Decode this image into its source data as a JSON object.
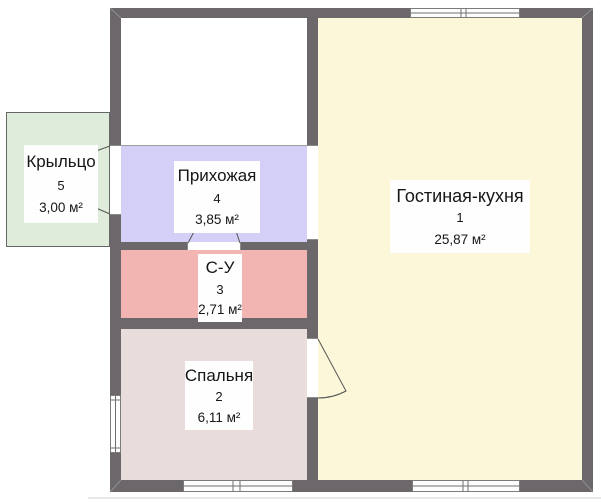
{
  "rooms": {
    "living": {
      "name": "Гостиная-кухня",
      "number": "1",
      "area": "25,87 м²"
    },
    "bedroom": {
      "name": "Спальня",
      "number": "2",
      "area": "6,11 м²"
    },
    "bathroom": {
      "name": "С-У",
      "number": "3",
      "area": "2,71 м²"
    },
    "hallway": {
      "name": "Прихожая",
      "number": "4",
      "area": "3,85 м²"
    },
    "porch": {
      "name": "Крыльцо",
      "number": "5",
      "area": "3,00 м²"
    }
  },
  "colors": {
    "wall": "#6b676a",
    "living": "#fbf7d8",
    "bedroom": "#e9dddc",
    "bathroom": "#f2b5b1",
    "hallway": "#d3cff7",
    "porch": "#e0ecdb",
    "unlabeled_room": "#ffffff"
  }
}
